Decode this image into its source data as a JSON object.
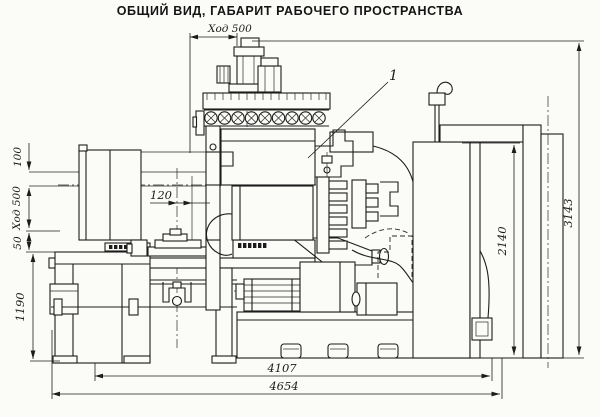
{
  "title": "ОБЩИЙ ВИД, ГАБАРИТ РАБОЧЕГО ПРОСТРАНСТВА",
  "drawing": {
    "dim_top_stroke": "Ход 500",
    "dim_left_100": "100",
    "dim_left_stroke": "Ход 500",
    "dim_left_50": "50",
    "dim_left_1190": "1190",
    "dim_center_120": "120",
    "dim_right_2140": "2140",
    "dim_right_3143": "3143",
    "dim_bottom_4107": "4107",
    "dim_bottom_4654": "4654",
    "callout_1": "1"
  },
  "colors": {
    "ink": "#1c1c1c",
    "paper": "#fbfbf8"
  }
}
